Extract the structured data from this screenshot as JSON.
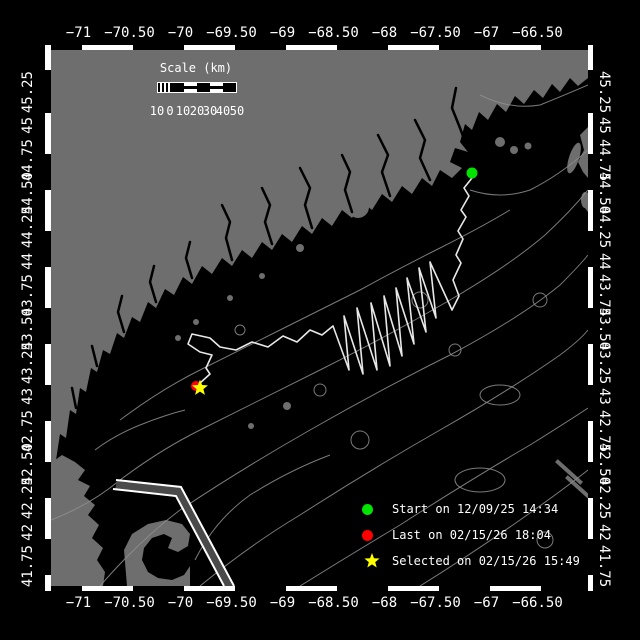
{
  "colors": {
    "background": "#000000",
    "ocean": "#000000",
    "land": "#6e6e6e",
    "contour": "#8f8f8f",
    "track": "#e8e8e8",
    "frame": "#ffffff",
    "text": "#ffffff",
    "start_marker": "#00e400",
    "last_marker": "#ff0000",
    "selected_marker": "#ffff00",
    "shipping_lane": "#4a4a4a"
  },
  "axes": {
    "longitude_labels": [
      "−71",
      "−70.50",
      "−70",
      "−69.50",
      "−69",
      "−68.50",
      "−68",
      "−67.50",
      "−67",
      "−66.50"
    ],
    "latitude_labels": [
      "45.25",
      "45",
      "44.75",
      "44.50",
      "44.25",
      "44",
      "43.75",
      "43.50",
      "43.25",
      "43",
      "42.75",
      "42.50",
      "42.25",
      "42",
      "41.75"
    ]
  },
  "scale_bar": {
    "title": "Scale (km)",
    "labels": [
      "10",
      "0",
      "10",
      "20",
      "30",
      "40",
      "50"
    ]
  },
  "legend": {
    "items": [
      {
        "name": "start",
        "marker": "green-dot",
        "color": "#00e400",
        "label": "Start on 12/09/25 14:34"
      },
      {
        "name": "last",
        "marker": "red-dot",
        "color": "#ff0000",
        "label": "Last on 02/15/26 18:04"
      },
      {
        "name": "selected",
        "marker": "yellow-star",
        "color": "#ffff00",
        "label": "Selected on 02/15/26 15:49"
      }
    ]
  }
}
